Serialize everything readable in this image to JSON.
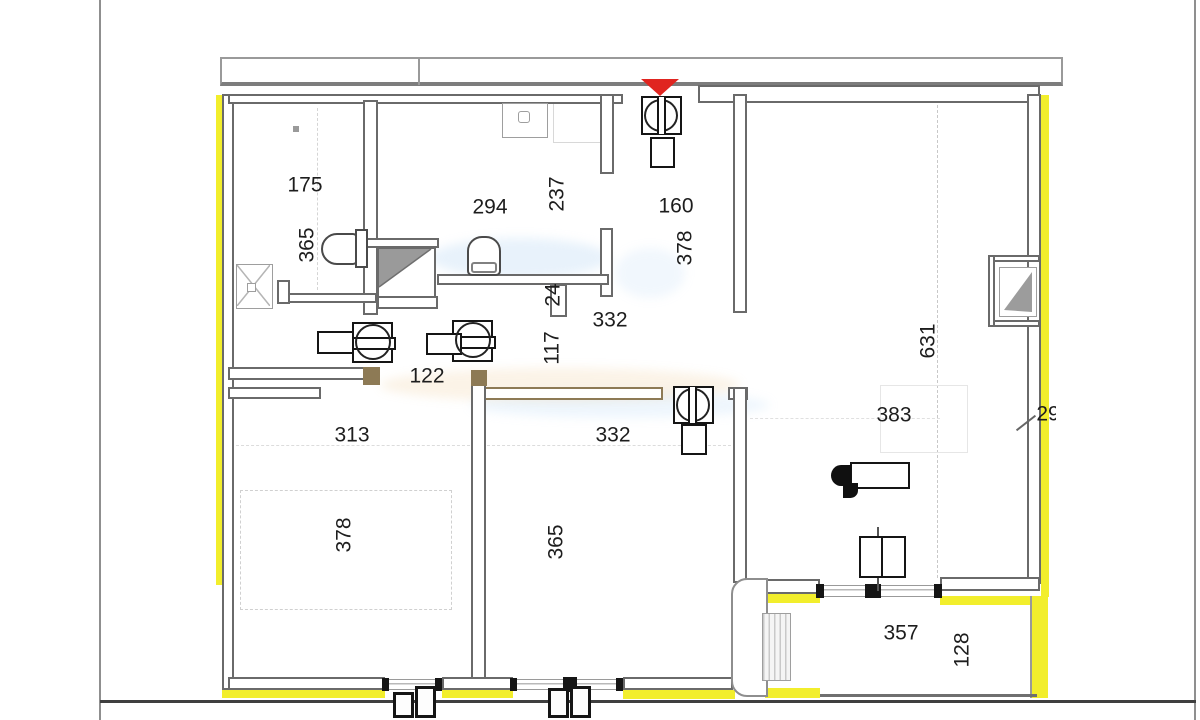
{
  "document": {
    "type": "architectural-floor-plan",
    "units_hint": "cm dimensions"
  },
  "colors": {
    "highlight": "#f2ee2c",
    "wall": "#6a6a6a",
    "walltan": "#8d7a55",
    "arrow": "#e02520",
    "dark": "#151515",
    "ground": "#3f3f3f",
    "lite": "#9a9a9a"
  },
  "labels": [
    {
      "id": "bath-left-width",
      "text": "175",
      "orientation": "horizontal"
    },
    {
      "id": "bath-left-height",
      "text": "365",
      "orientation": "vertical"
    },
    {
      "id": "bath-mid-width",
      "text": "294",
      "orientation": "horizontal"
    },
    {
      "id": "bath-mid-height",
      "text": "237",
      "orientation": "vertical"
    },
    {
      "id": "hall-width",
      "text": "160",
      "orientation": "horizontal"
    },
    {
      "id": "hall-height",
      "text": "378",
      "orientation": "vertical"
    },
    {
      "id": "corridor-length",
      "text": "332",
      "orientation": "horizontal"
    },
    {
      "id": "wall-thickness",
      "text": "24",
      "orientation": "vertical"
    },
    {
      "id": "corridor-width",
      "text": "117",
      "orientation": "vertical"
    },
    {
      "id": "passage-width",
      "text": "122",
      "orientation": "horizontal"
    },
    {
      "id": "living-height",
      "text": "631",
      "orientation": "vertical"
    },
    {
      "id": "living-width",
      "text": "383",
      "orientation": "horizontal"
    },
    {
      "id": "clipped-dim",
      "text": "29",
      "orientation": "horizontal"
    },
    {
      "id": "bedroom-left-width",
      "text": "313",
      "orientation": "horizontal"
    },
    {
      "id": "bedroom-mid-width",
      "text": "332",
      "orientation": "horizontal"
    },
    {
      "id": "bedroom-left-height",
      "text": "378",
      "orientation": "vertical"
    },
    {
      "id": "bedroom-mid-height",
      "text": "365",
      "orientation": "vertical"
    },
    {
      "id": "balcony-width",
      "text": "357",
      "orientation": "horizontal"
    },
    {
      "id": "balcony-depth",
      "text": "128",
      "orientation": "vertical"
    }
  ],
  "fixtures": {
    "entrance-arrow-icon": "red triangle pointing down at entry door",
    "entry-appliance-icon": "square with circle and double bar",
    "hall-washer-icon": "square with circle and double bar, small box below",
    "washing-machine-icon": "square with drum circle, band and side box (x2)",
    "toilet-icon": "rounded bowl with cistern (x2)",
    "sink-icon": "square basin with tap circle",
    "shower-tray-icon": "square with X diagonals",
    "shower-cabin-icon": "box with gray sloped triangle",
    "window-niche-icon": "recessed box with gray triangle on right wall",
    "tv-unit-icon": "black wedges with white board",
    "floor-appliance-icon": "double black square",
    "radiator-icon": "striped rectangle on balcony",
    "pillar-icon": "rounded white column",
    "roller-shutter-box-icon": "black boxes under windows",
    "window-icon": "double glazing line with black end caps"
  }
}
